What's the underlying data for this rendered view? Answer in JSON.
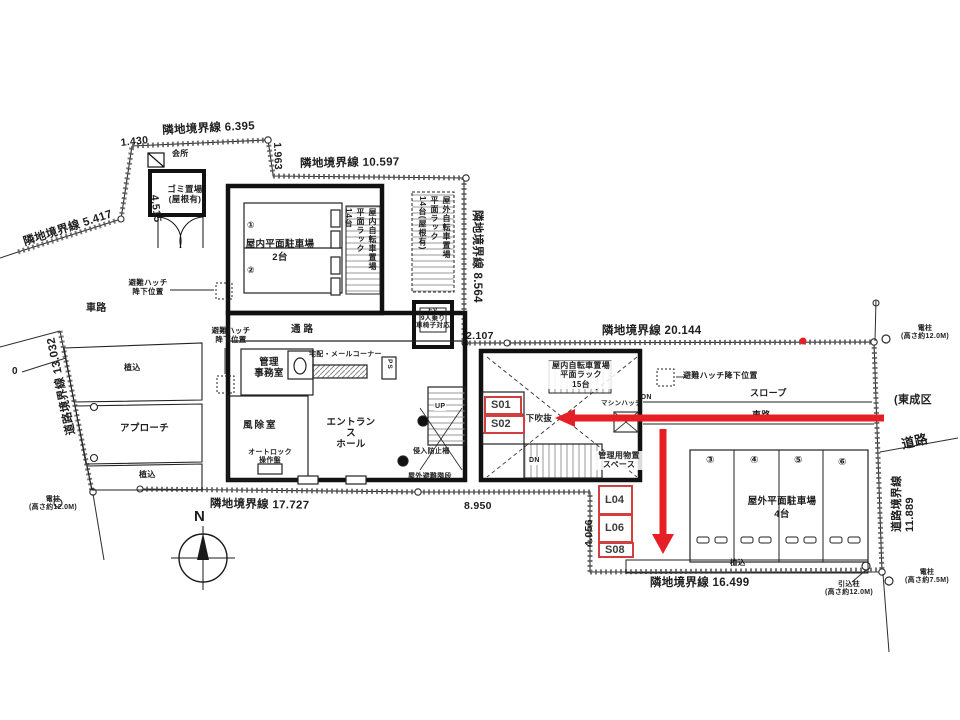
{
  "meta": {
    "drawing_type": "architectural site / ground floor plan (Japanese)",
    "paper_color": "#ffffff",
    "ink_color": "#1e1e1e",
    "red_annotation_color": "#e61e26",
    "red_tag_border_color": "#d04040"
  },
  "t": {
    "d1430": "1.430",
    "b6395": "隣地境界線  6.395",
    "d1963": "1.963",
    "b10597": "隣地境界線  10.597",
    "b8564": "隣地境界線 8.564",
    "b5417": "隣地境界線  5.417",
    "d4515": "4.515",
    "b13032": "道路境界線 13.032",
    "b20144": "隣地境界線  20.144",
    "d2107": "2.107",
    "b17727": "隣地境界線  17.727",
    "d8950": "8.950",
    "d4056": "4.056",
    "b16499": "隣地境界線  16.499",
    "b11889": "道路境界線 11.889",
    "road": "道路",
    "tosei": "(東成区",
    "zero": "0",
    "pole12a": "電柱\n(高さ約12.0M)",
    "pole12b": "電柱\n(高さ約12.0M)",
    "pole75": "電柱\n(高さ約7.5M)",
    "hikikomi": "引込柱\n(高さ約12.0M)",
    "kaisho": "会所",
    "gomi": "ゴミ置場\n(屋根有)",
    "sharo1": "車路",
    "sharo2": "車路",
    "hatchA": "避難ハッチ\n降下位置",
    "hatchB": "避難ハッチ\n降下位置",
    "hatchC": "避難ハッチ降下位置",
    "pk_in": "屋内平面駐車場",
    "pk_in_n": "2台",
    "n1": "①",
    "n2": "②",
    "n3": "③",
    "n4": "④",
    "n5": "⑤",
    "n6": "⑥",
    "bike_in14": "屋内自転車置場\n平面ラック\n14台",
    "bike_out14": "屋外自転車置場\n平面ラック\n14台(屋根有)",
    "ev": "EV\n9人乗り\n(車椅子対応)",
    "tsuro": "通路",
    "kanri": "管理\n事務室",
    "mail": "宅配・メールコーナー",
    "ps": "PS",
    "fujo": "風除室",
    "ent": "エントランス\nホール",
    "autolock": "オートロック\n操作盤",
    "up": "UP",
    "dn1": "DN",
    "dn2": "DN",
    "fence": "侵入防止柵",
    "exstair": "屋外避難階段",
    "bike_in15": "屋内自転車置場\n平面ラック\n15台",
    "machine": "マシンハッチ",
    "chika": "地下吹抜",
    "storage": "管理用物置\nスペース",
    "slope": "スロープ",
    "pk_out": "屋外平面駐車場",
    "pk_out_n": "4台",
    "ueki1": "植込",
    "ueki2": "植込",
    "ueki3": "植込",
    "approach": "アプローチ",
    "north": "N"
  },
  "red": {
    "tags": [
      {
        "label": "S01"
      },
      {
        "label": "S02"
      },
      {
        "label": "L04"
      },
      {
        "label": "L06"
      },
      {
        "label": "S08"
      }
    ]
  }
}
